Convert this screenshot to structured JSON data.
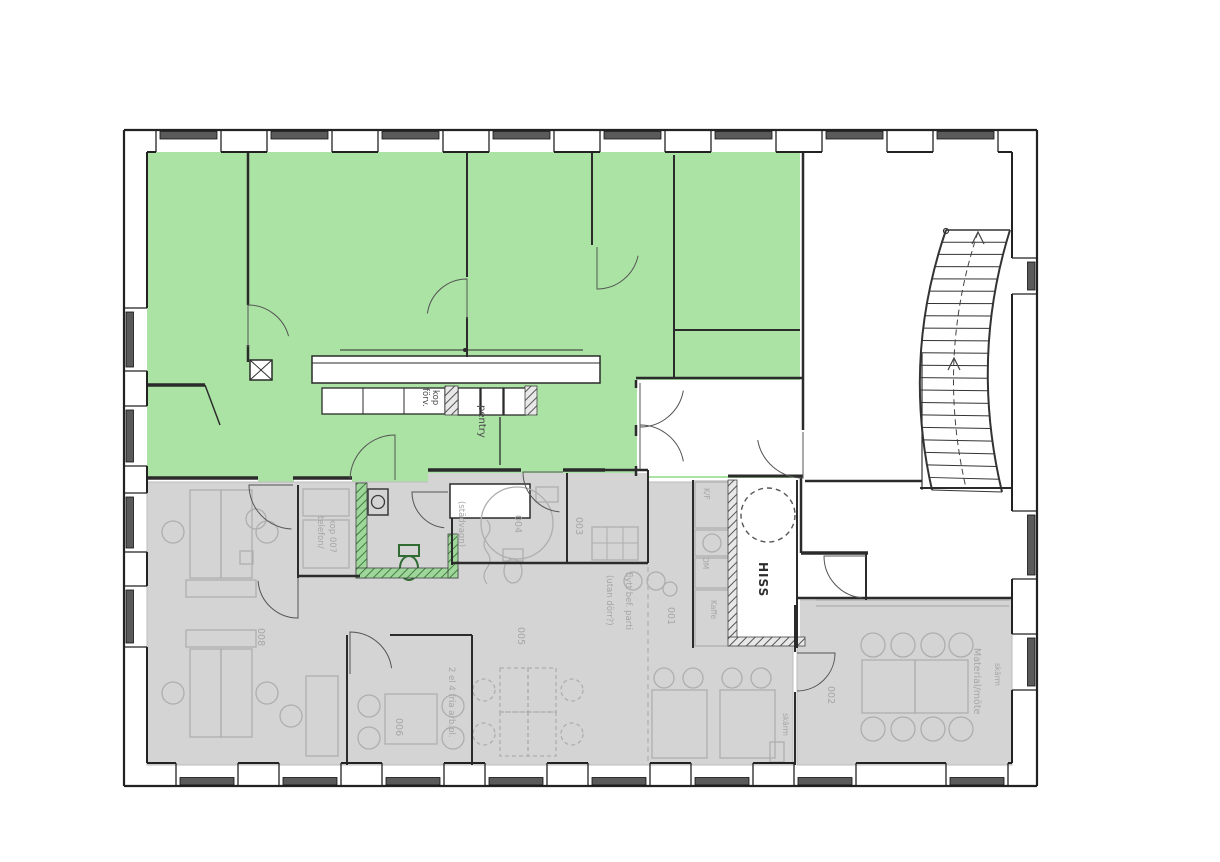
{
  "plan": {
    "highlight_colors": {
      "green": "#ABE3A4",
      "gray": "#D4D4D4"
    },
    "rooms": {
      "r001": "001",
      "r002": "002",
      "r003": "003",
      "r004": "004",
      "r005": "005",
      "r006": "006",
      "r008": "008"
    },
    "labels": {
      "hiss": "HISS",
      "pentry": "pentry",
      "kop": "kop",
      "forv": "förv.",
      "telefon_line1": "telefon/",
      "telefon_line2": "kop 007",
      "stadvagn": "(städvagn)",
      "arbpl": "2 el 4 fria arb.pl.",
      "flytt_line1": "flytt bef. parti",
      "flytt_line2": "(utan dörr?)",
      "material": "Material/möte",
      "skarm_right": "skärm",
      "skarm_left": "skärm",
      "kf": "K/F",
      "dm": "DM",
      "kaffe": "Kaffe"
    }
  }
}
